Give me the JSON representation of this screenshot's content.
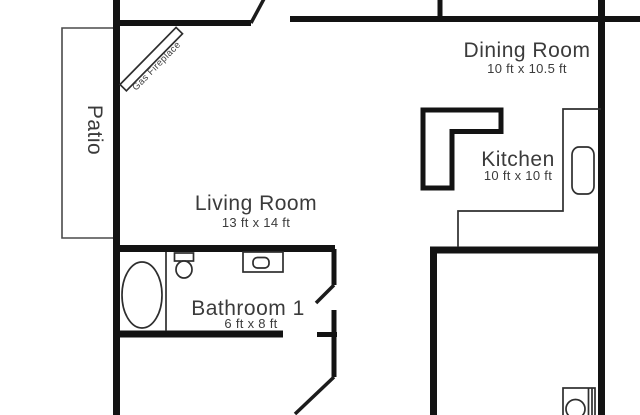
{
  "title": "Apartment floor plan",
  "rooms": [
    {
      "id": "living-room",
      "name": "Living Room",
      "dimensions": "13 ft x 14 ft"
    },
    {
      "id": "dining-room",
      "name": "Dining Room",
      "dimensions": "10 ft x 10.5 ft"
    },
    {
      "id": "kitchen",
      "name": "Kitchen",
      "dimensions": "10 ft x 10 ft"
    },
    {
      "id": "bathroom-1",
      "name": "Bathroom 1",
      "dimensions": "6 ft x 8 ft"
    },
    {
      "id": "patio",
      "name": "Patio",
      "dimensions": ""
    }
  ],
  "features": {
    "fireplace": {
      "label": "Gas Fireplace"
    }
  },
  "fixtures": [
    "bathtub",
    "toilet",
    "sink-vanity",
    "refrigerator",
    "kitchen-counter",
    "washer"
  ],
  "colors": {
    "wall": "#131313",
    "text": "#3b3b3b",
    "thin_line": "#2e2e2e",
    "patio_line": "#4a4a4a",
    "background": "#ffffff"
  }
}
